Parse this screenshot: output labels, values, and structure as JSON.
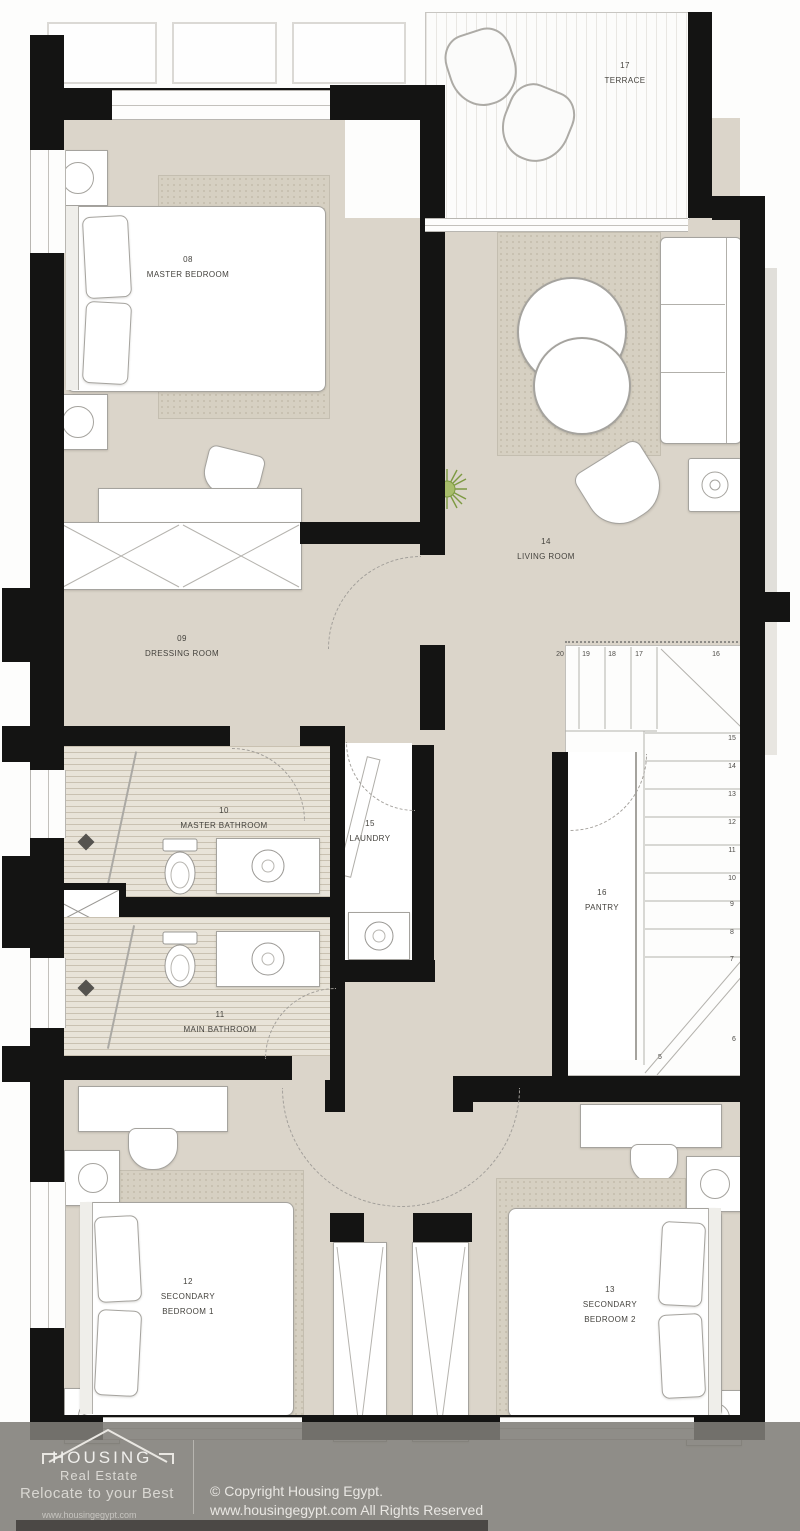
{
  "colors": {
    "wall": "#141413",
    "floor": "#dbd5ca",
    "bath_floor": "#e8e3d8",
    "rug": "#d6d0c2",
    "outline": "#a5a39e",
    "label_text": "#44423d",
    "plant": "#7d9a42",
    "footer_bg": "#807d79",
    "footer_text": "#eceae6"
  },
  "labels": {
    "terrace": {
      "num": "17",
      "name": "TERRACE"
    },
    "master_bedroom": {
      "num": "08",
      "name": "MASTER BEDROOM"
    },
    "dressing_room": {
      "num": "09",
      "name": "DRESSING ROOM"
    },
    "living_room": {
      "num": "14",
      "name": "LIVING ROOM"
    },
    "master_bathroom": {
      "num": "10",
      "name": "MASTER BATHROOM"
    },
    "laundry": {
      "num": "15",
      "name": "LAUNDRY"
    },
    "main_bathroom": {
      "num": "11",
      "name": "MAIN BATHROOM"
    },
    "pantry": {
      "num": "16",
      "name": "PANTRY"
    },
    "secondary_bedroom_1": {
      "num": "12",
      "line1": "SECONDARY",
      "line2": "BEDROOM 1"
    },
    "secondary_bedroom_2": {
      "num": "13",
      "line1": "SECONDARY",
      "line2": "BEDROOM 2"
    }
  },
  "stairs": {
    "top": [
      "20",
      "19",
      "18",
      "17",
      "16"
    ],
    "right": [
      "15",
      "14",
      "13",
      "12",
      "11",
      "10",
      "9",
      "8",
      "7"
    ],
    "bottom": [
      "6",
      "5"
    ]
  },
  "footer": {
    "brand": "HOUSING",
    "brand_sub": "Real Estate",
    "tagline": "Relocate to your Best",
    "brand_url": "www.housingegypt.com",
    "copyright_line1": "© Copyright Housing Egypt.",
    "copyright_line2": "www.housingegypt.com All Rights Reserved"
  }
}
